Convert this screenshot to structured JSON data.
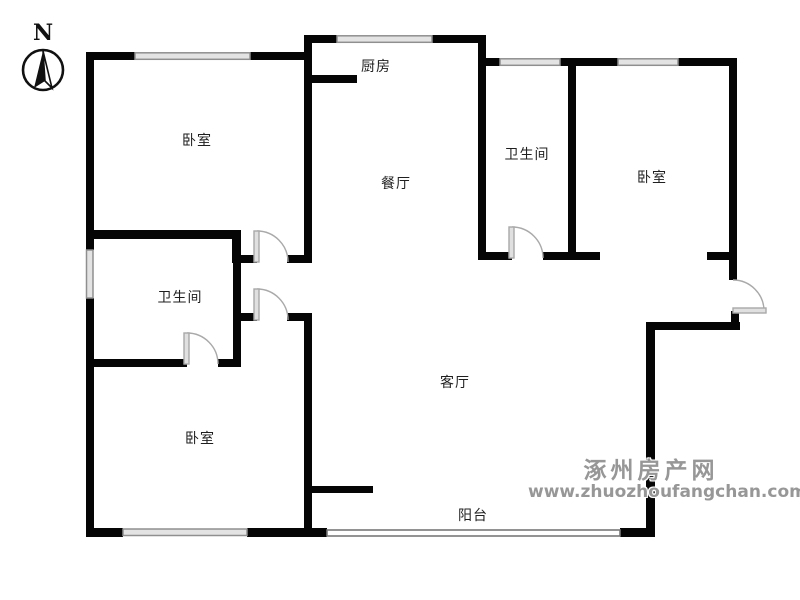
{
  "compass": {
    "north_label": "N"
  },
  "rooms": {
    "kitchen": {
      "label": "厨房"
    },
    "dining": {
      "label": "餐厅"
    },
    "living": {
      "label": "客厅"
    },
    "balcony": {
      "label": "阳台"
    },
    "bedroom_top_left": {
      "label": "卧室"
    },
    "bedroom_right": {
      "label": "卧室"
    },
    "bedroom_bottom_left": {
      "label": "卧室"
    },
    "bathroom_left": {
      "label": "卫生间"
    },
    "bathroom_middle": {
      "label": "卫生间"
    }
  },
  "watermark": {
    "site_name": "涿州房产网",
    "site_url": "www.zhuozhoufangchan.com"
  },
  "colors": {
    "wall": "#050505",
    "window_fill": "#e3e3e3",
    "window_edge": "#8f8f8f",
    "door_line": "#aaaaaa",
    "label_text": "#1f1f1f",
    "watermark_gray": "#979797"
  }
}
